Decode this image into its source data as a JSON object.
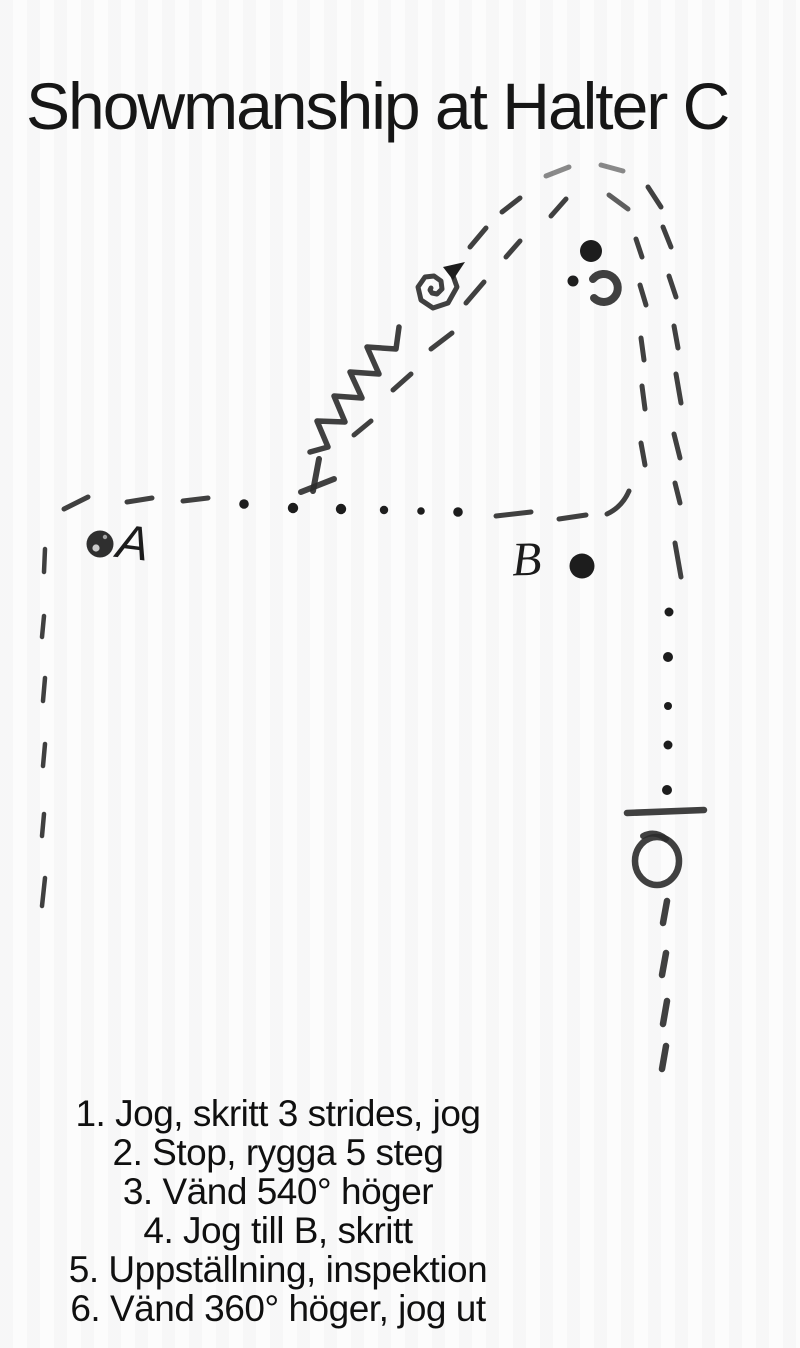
{
  "title": "Showmanship at Halter C",
  "pattern": {
    "marker_a": "A",
    "marker_b": "B",
    "symbols": {
      "dashed_line": "jog-gait-path",
      "dotted_line": "walk-gait-path",
      "zigzag": "back-up-5-steps",
      "spiral": "turn-540-degrees-right",
      "circle_arrow": "turn-360-degrees-right",
      "t_mark": "stop-mark",
      "bar": "inspection-stop-bar",
      "filled_dots": "cone-markers"
    },
    "ink_color": "#2b2b2b"
  },
  "instructions": [
    "1. Jog, skritt 3 strides, jog",
    "2. Stop, rygga 5 steg",
    "3. Vänd 540° höger",
    "4. Jog till B, skritt",
    "5. Uppställning, inspektion",
    "6. Vänd 360° höger, jog ut"
  ]
}
